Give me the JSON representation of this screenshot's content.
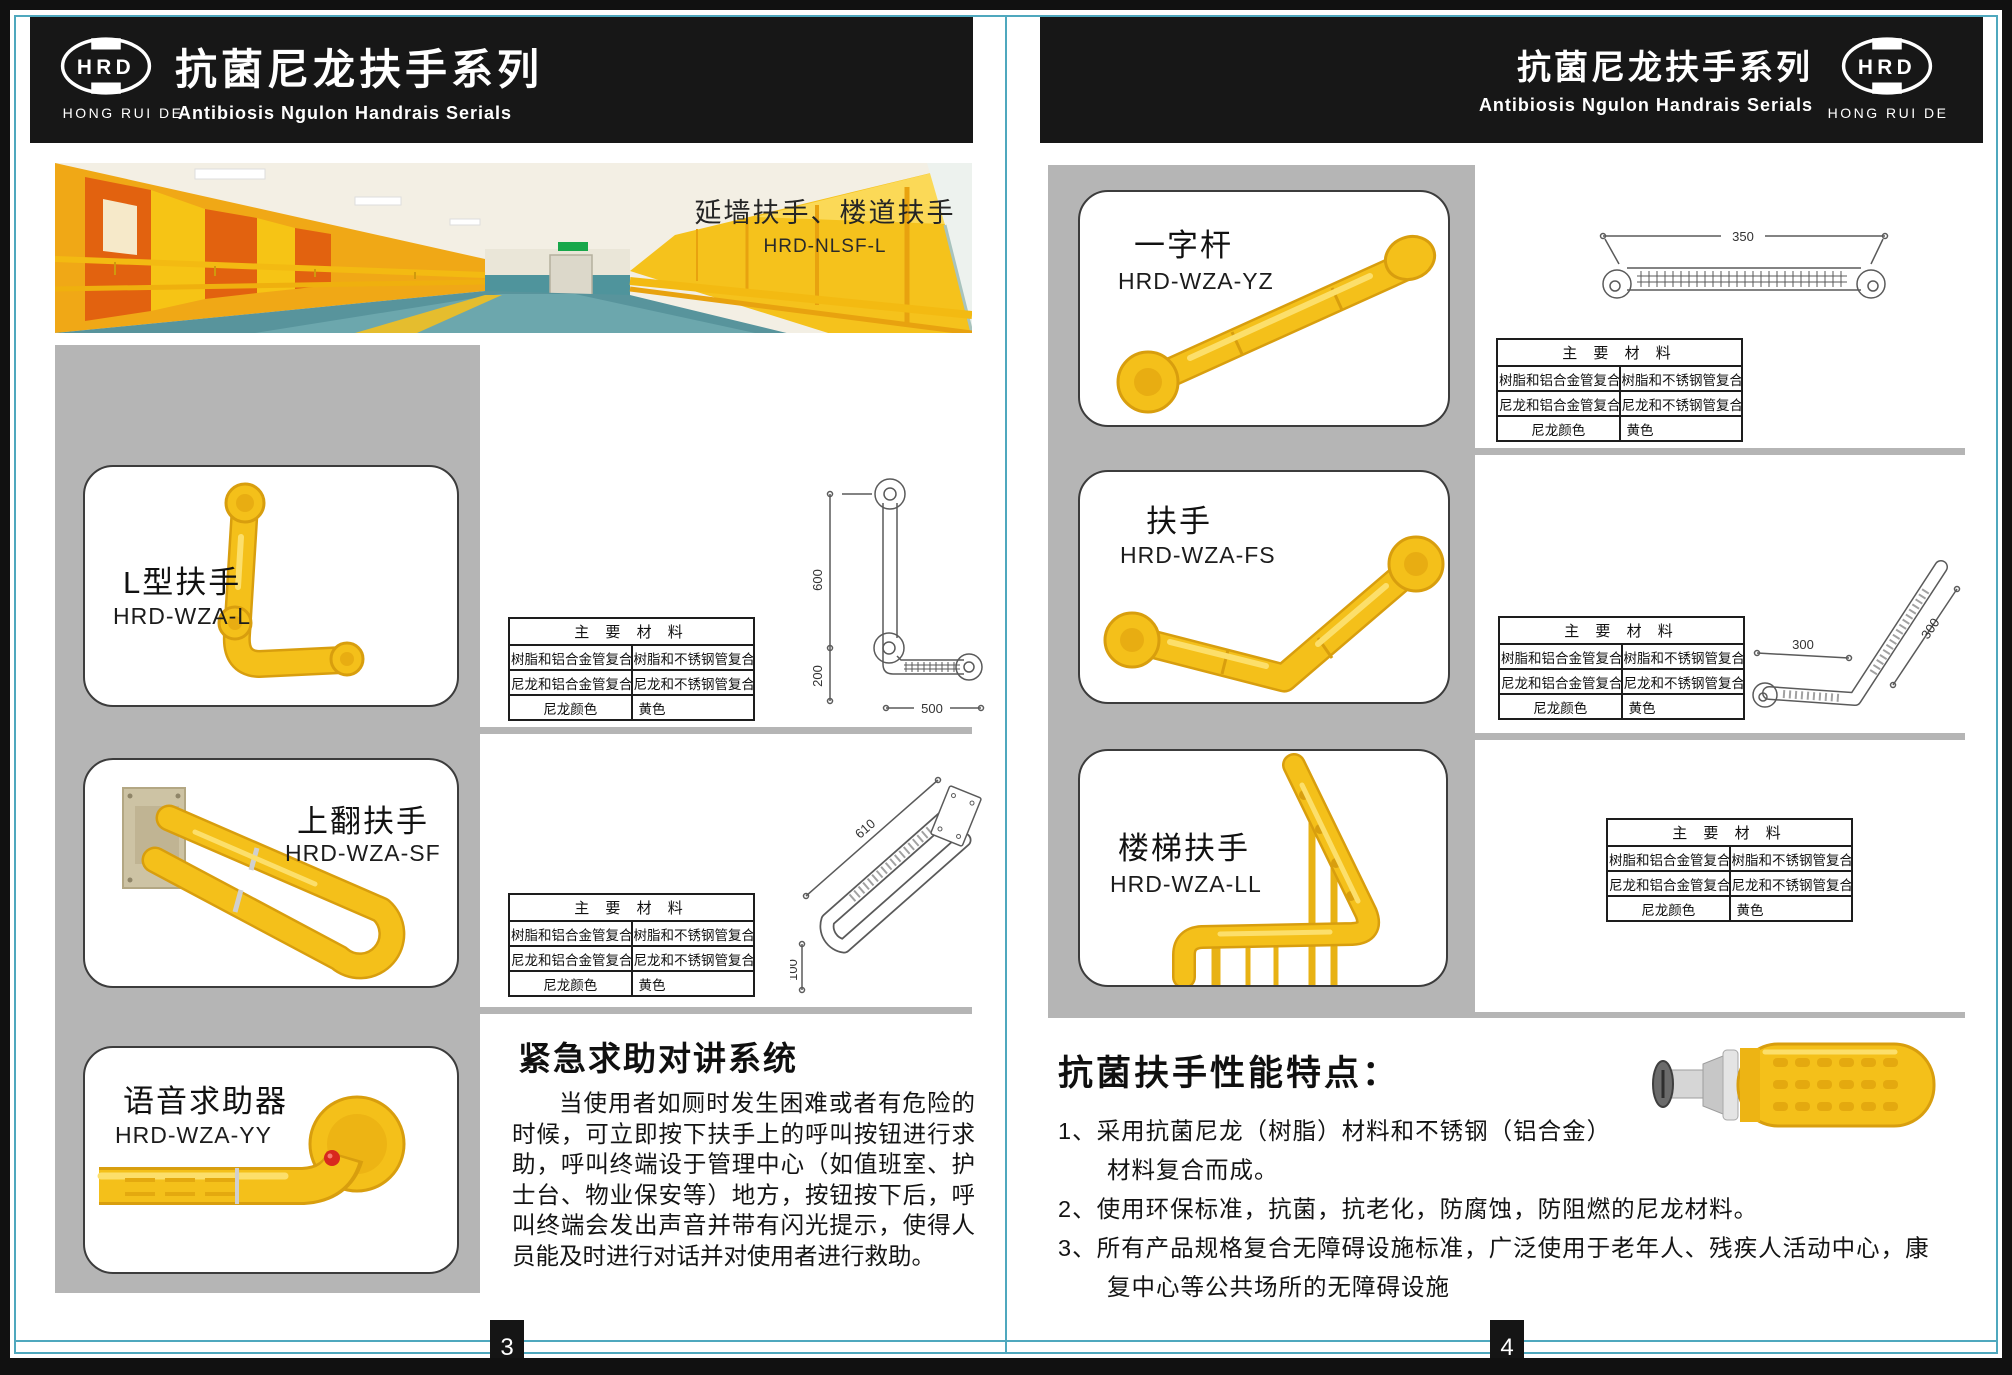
{
  "header": {
    "logo_text": "HRD",
    "logo_sub": "HONG RUI DE",
    "title": "抗菌尼龙扶手系列",
    "subtitle": "Antibiosis Ngulon Handrais Serials"
  },
  "banner": {
    "caption": "延墙扶手、楼道扶手",
    "model": "HRD-NLSF-L"
  },
  "materials": {
    "header": "主 要 材 料",
    "rows": [
      [
        "树脂和铝合金管复合",
        "树脂和不锈钢管复合"
      ],
      [
        "尼龙和铝合金管复合",
        "尼龙和不锈钢管复合"
      ],
      [
        "尼龙颜色",
        "黄色"
      ]
    ]
  },
  "left_page": {
    "page_number": "3",
    "products": [
      {
        "name": "L型扶手",
        "model": "HRD-WZA-L",
        "dim_a": "600",
        "dim_b": "200",
        "dim_c": "500"
      },
      {
        "name": "上翻扶手",
        "model": "HRD-WZA-SF",
        "dim_a": "610",
        "dim_b": "100"
      },
      {
        "name": "语音求助器",
        "model": "HRD-WZA-YY"
      }
    ],
    "emergency": {
      "title": "紧急求助对讲系统",
      "body": "当使用者如厕时发生困难或者有危险的时候，可立即按下扶手上的呼叫按钮进行求助，呼叫终端设于管理中心（如值班室、护士台、物业保安等）地方，按钮按下后，呼叫终端会发出声音并带有闪光提示，使得人员能及时进行对话并对使用者进行救助。"
    }
  },
  "right_page": {
    "page_number": "4",
    "products": [
      {
        "name": "一字杆",
        "model": "HRD-WZA-YZ",
        "dim_a": "350"
      },
      {
        "name": "扶手",
        "model": "HRD-WZA-FS",
        "dim_a": "300",
        "dim_b": "300"
      },
      {
        "name": "楼梯扶手",
        "model": "HRD-WZA-LL"
      }
    ],
    "features": {
      "title": "抗菌扶手性能特点：",
      "items": [
        {
          "lines": [
            "1、采用抗菌尼龙（树脂）材料和不锈钢（铝合金）",
            "材料复合而成。"
          ]
        },
        {
          "lines": [
            "2、使用环保标准，抗菌，抗老化，防腐蚀，防阻燃的尼龙材料。"
          ]
        },
        {
          "lines": [
            "3、所有产品规格复合无障碍设施标准，广泛使用于老年人、残疾人活动中心，康",
            "复中心等公共场所的无障碍设施"
          ]
        }
      ]
    }
  },
  "colors": {
    "accent_yellow": "#F4C01A",
    "teal_guide": "#4FA8BE",
    "panel_gray": "#B5B5B5",
    "header_black": "#171717"
  }
}
